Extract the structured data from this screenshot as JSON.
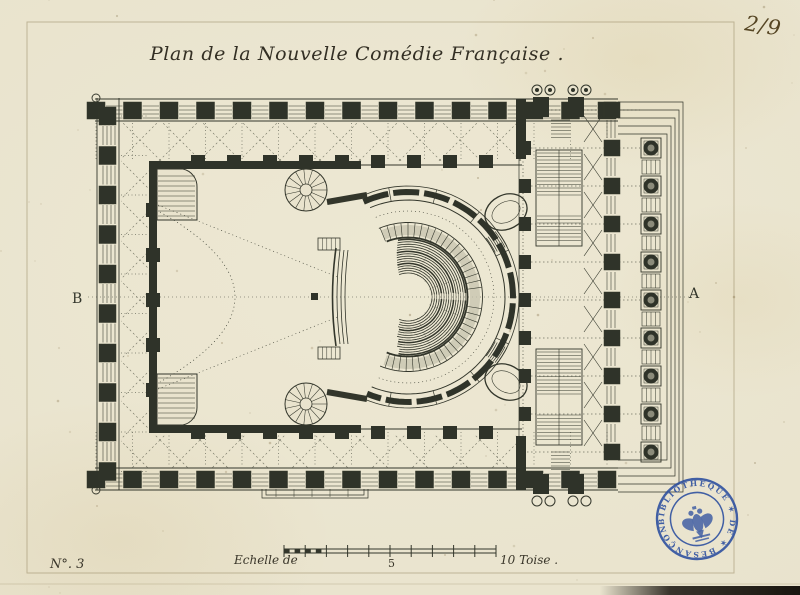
{
  "document": {
    "title": "Plan de la Nouvelle Comédie Française .",
    "page_number": "2/9",
    "plate_number": "N°. 3"
  },
  "labels": {
    "left_marker": "B",
    "right_marker": "A"
  },
  "scale_bar": {
    "prefix": "Echelle de",
    "middle_value": "5",
    "end_value": "10 Toise ."
  },
  "stamp": {
    "text": "BIBLIOTHEQUE ✶ DE ✶ BESANÇON",
    "color": "#2a4d9f"
  },
  "colors": {
    "paper": "#e9e3cd",
    "ink": "#33362b",
    "pier": "#2f3329",
    "halftone": "#c6c3ae",
    "dots": "#52544a",
    "platemark": "#8a7a52",
    "handwriting": "#564624",
    "stamp_blue": "#2a4d9f"
  }
}
